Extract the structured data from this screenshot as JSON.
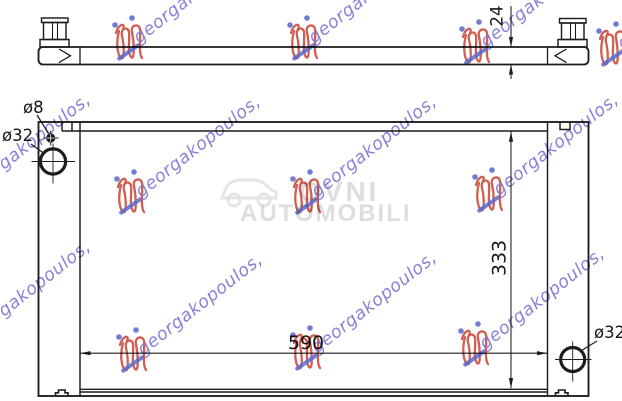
{
  "drawing": {
    "dim_depth": "24",
    "dim_height": "333",
    "dim_width": "590",
    "label_hole_small": "ø8",
    "label_hole_top": "ø32",
    "label_hole_bottom": "ø32"
  },
  "watermark": {
    "brand_text": "georgakopoulos,",
    "center_top": "OVNI",
    "center_bottom": "AUTOMOBILI",
    "script_color": "#8276d4",
    "logo_color": "#c9493b",
    "dot_color": "#5b6ccc",
    "center_color": "#c4c4ca"
  }
}
